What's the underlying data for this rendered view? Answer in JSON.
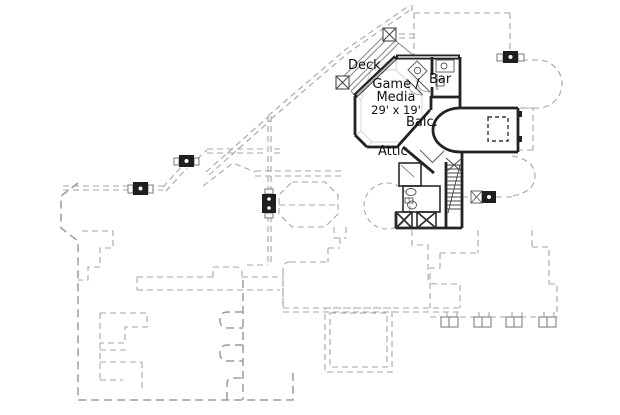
{
  "plan": {
    "type": "floor-plan-drawing",
    "labels": {
      "deck": "Deck.",
      "game_line1": "Game /",
      "game_line2": "Media",
      "game_dims": "29' x 19'",
      "bar": "Bar",
      "balcony": "Balc.",
      "attic": "Attic"
    },
    "colors": {
      "background": "#ffffff",
      "wall": "#232323",
      "wall_fill": "#b5b5b5",
      "dashed_outline": "#a6a6a6",
      "ceiling_line": "#d4d4d4",
      "fixture_line": "#555555",
      "label_text": "#111111"
    }
  }
}
